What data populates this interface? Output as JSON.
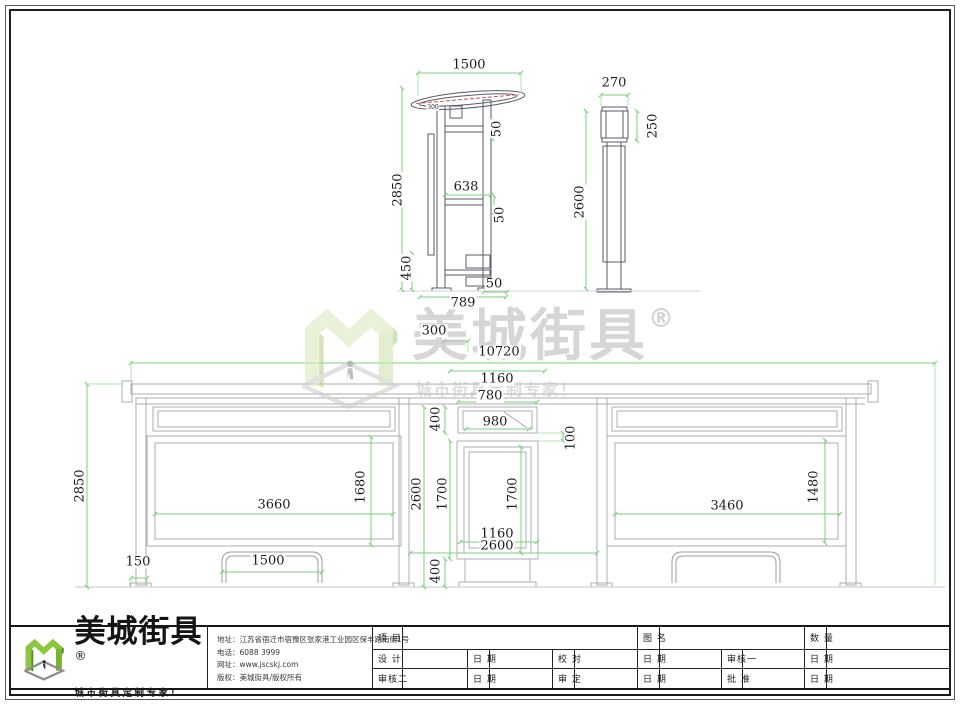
{
  "colors": {
    "accent_green": "#7cb83a",
    "dim_line_green": "#7ccf7c",
    "top_view_line": "#595a64",
    "elevation_line": "#aaacb0",
    "canopy_detail_red": "#cc5555",
    "watermark_gray": "#c4c4c4",
    "text": "#1b1b1b"
  },
  "watermark": {
    "brand": "美城街具",
    "reg": "®",
    "tagline": "城市街具定制专家！"
  },
  "dimensions": [
    {
      "t": "1500",
      "x": 469,
      "y": 65,
      "r": 0,
      "s": 13
    },
    {
      "t": "300",
      "x": 433,
      "y": 108,
      "r": 0,
      "s": 6
    },
    {
      "t": "2850",
      "x": 398,
      "y": 190,
      "r": 1,
      "s": 13
    },
    {
      "t": "50",
      "x": 497,
      "y": 129,
      "r": 1,
      "s": 13
    },
    {
      "t": "638",
      "x": 466,
      "y": 187,
      "r": 0,
      "s": 13
    },
    {
      "t": "50",
      "x": 500,
      "y": 215,
      "r": 1,
      "s": 13
    },
    {
      "t": "450",
      "x": 407,
      "y": 268,
      "r": 1,
      "s": 13
    },
    {
      "t": "50",
      "x": 494,
      "y": 284,
      "r": 0,
      "s": 13
    },
    {
      "t": "789",
      "x": 463,
      "y": 303,
      "r": 0,
      "s": 13
    },
    {
      "t": "270",
      "x": 614,
      "y": 83,
      "r": 0,
      "s": 13
    },
    {
      "t": "250",
      "x": 653,
      "y": 126,
      "r": 1,
      "s": 13
    },
    {
      "t": "2600",
      "x": 580,
      "y": 202,
      "r": 1,
      "s": 13
    },
    {
      "t": "300",
      "x": 434,
      "y": 331,
      "r": 0,
      "s": 13
    },
    {
      "t": "10720",
      "x": 499,
      "y": 352,
      "r": 0,
      "s": 13
    },
    {
      "t": "1160",
      "x": 497,
      "y": 379,
      "r": 0,
      "s": 13
    },
    {
      "t": "780",
      "x": 490,
      "y": 396,
      "r": 0,
      "s": 13
    },
    {
      "t": "400",
      "x": 436,
      "y": 419,
      "r": 1,
      "s": 13
    },
    {
      "t": "980",
      "x": 495,
      "y": 422,
      "r": 0,
      "s": 13
    },
    {
      "t": "100",
      "x": 571,
      "y": 438,
      "r": 1,
      "s": 13
    },
    {
      "t": "2850",
      "x": 80,
      "y": 486,
      "r": 1,
      "s": 13
    },
    {
      "t": "2600",
      "x": 417,
      "y": 494,
      "r": 1,
      "s": 13
    },
    {
      "t": "1700",
      "x": 443,
      "y": 494,
      "r": 1,
      "s": 13
    },
    {
      "t": "1700",
      "x": 513,
      "y": 494,
      "r": 1,
      "s": 13
    },
    {
      "t": "1680",
      "x": 361,
      "y": 487,
      "r": 1,
      "s": 13
    },
    {
      "t": "3660",
      "x": 274,
      "y": 505,
      "r": 0,
      "s": 13
    },
    {
      "t": "1160",
      "x": 497,
      "y": 534,
      "r": 0,
      "s": 13
    },
    {
      "t": "2600",
      "x": 497,
      "y": 546,
      "r": 0,
      "s": 13
    },
    {
      "t": "400",
      "x": 436,
      "y": 571,
      "r": 1,
      "s": 13
    },
    {
      "t": "1480",
      "x": 814,
      "y": 487,
      "r": 1,
      "s": 13
    },
    {
      "t": "3460",
      "x": 727,
      "y": 506,
      "r": 0,
      "s": 13
    },
    {
      "t": "150",
      "x": 138,
      "y": 562,
      "r": 0,
      "s": 13
    },
    {
      "t": "1500",
      "x": 268,
      "y": 561,
      "r": 0,
      "s": 13
    }
  ],
  "title_block": {
    "logo": {
      "brand": "美城街具",
      "reg": "®",
      "tagline": "城市街具定制专家！"
    },
    "company": [
      {
        "label": "地址：",
        "value": "江苏省宿迁市宿豫区张家港工业园区保丰路南侧1号"
      },
      {
        "label": "电话：",
        "value": "6088 3999"
      },
      {
        "label": "网址：",
        "value": "www.jscskj.com"
      },
      {
        "label": "版权：",
        "value": "美城街具/版权所有"
      }
    ],
    "table": {
      "rows": [
        {
          "cells": [
            {
              "t": "项 目",
              "cs": 1
            },
            {
              "t": "",
              "cs": 5
            },
            {
              "t": "图 名",
              "cs": 1
            },
            {
              "t": "",
              "cs": 3
            },
            {
              "t": "数 量",
              "cs": 1
            },
            {
              "t": "",
              "cs": 1
            }
          ]
        },
        {
          "cells": [
            {
              "t": "设 计",
              "cs": 1
            },
            {
              "t": "",
              "cs": 1
            },
            {
              "t": "日 期",
              "cs": 1
            },
            {
              "t": "",
              "cs": 1
            },
            {
              "t": "校 对",
              "cs": 1
            },
            {
              "t": "",
              "cs": 1
            },
            {
              "t": "日 期",
              "cs": 1
            },
            {
              "t": "",
              "cs": 1
            },
            {
              "t": "审核一",
              "cs": 1
            },
            {
              "t": "",
              "cs": 1
            },
            {
              "t": "日 期",
              "cs": 1
            },
            {
              "t": "",
              "cs": 1
            }
          ]
        },
        {
          "cells": [
            {
              "t": "审核二",
              "cs": 1
            },
            {
              "t": "",
              "cs": 1
            },
            {
              "t": "日 期",
              "cs": 1
            },
            {
              "t": "",
              "cs": 1
            },
            {
              "t": "审 定",
              "cs": 1
            },
            {
              "t": "",
              "cs": 1
            },
            {
              "t": "日 期",
              "cs": 1
            },
            {
              "t": "",
              "cs": 1
            },
            {
              "t": "批 准",
              "cs": 1
            },
            {
              "t": "",
              "cs": 1
            },
            {
              "t": "日 期",
              "cs": 1
            },
            {
              "t": "",
              "cs": 1
            }
          ]
        }
      ]
    }
  }
}
